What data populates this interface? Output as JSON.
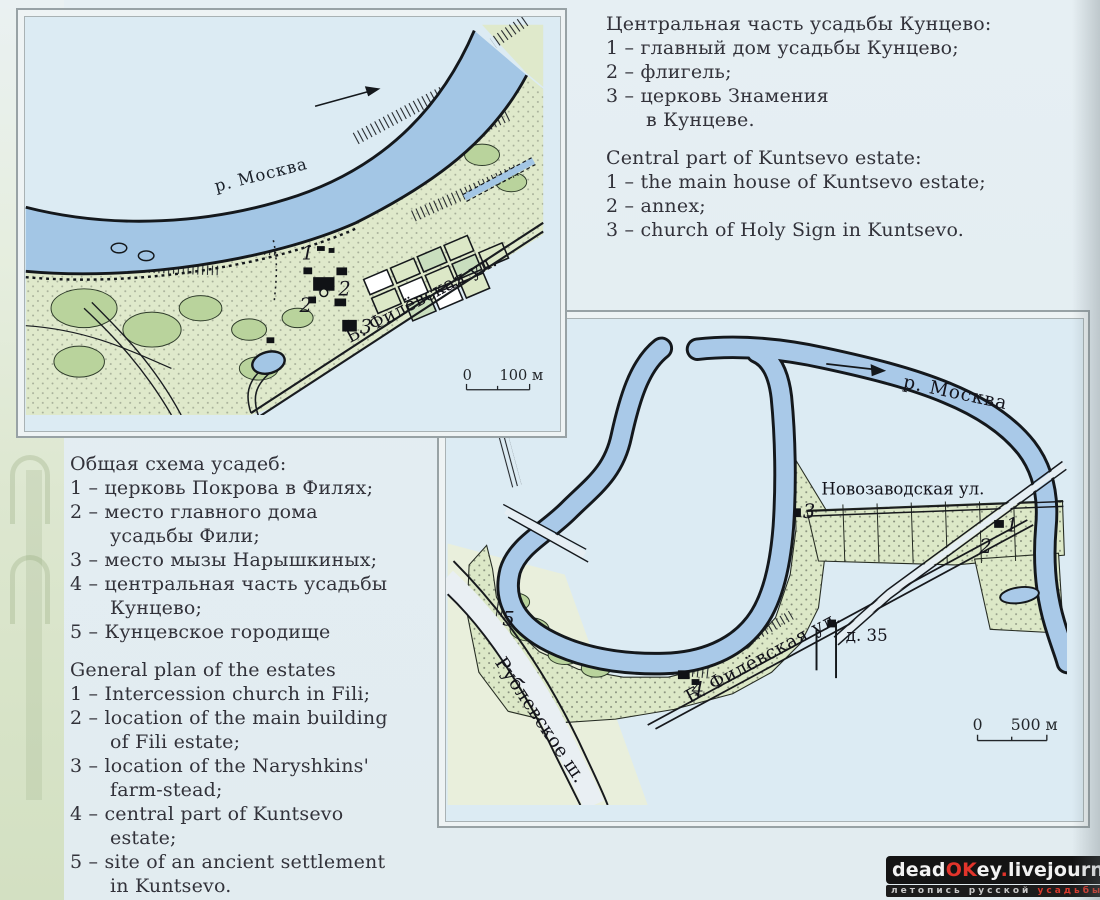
{
  "palette": {
    "paper": "#dcebf3",
    "river": "#a9c9e8",
    "land": "#dde8c9",
    "tree": "#b9d39c",
    "frame": "#98a2a5",
    "ink": "#14181c",
    "watermark_red": "#c1272d"
  },
  "legends": {
    "kuntsevo_ru": [
      "Центральная часть усадьбы Кунцево:",
      "1 – главный дом усадьбы Кунцево;",
      "2 – флигель;",
      "3 – церковь Знамения",
      "в Кунцеве."
    ],
    "kuntsevo_en": [
      "Central part of Kuntsevo estate:",
      "1 – the main house of Kuntsevo estate;",
      "2 – annex;",
      "3 – church of Holy Sign in Kuntsevo."
    ],
    "general_ru": [
      "Общая схема усадеб:",
      "1 – церковь Покрова в Филях;",
      "2 – место главного дома",
      "усадьбы Фили;",
      "3 – место мызы Нарышкиных;",
      "4 – центральная часть усадьбы",
      "Кунцево;",
      "5 – Кунцевское городище"
    ],
    "general_en": [
      "General plan of the estates",
      "1 – Intercession church in Fili;",
      "2 – location of the main building",
      "of Fili estate;",
      "3 – location of the Naryshkins'",
      "farm-stead;",
      "4 – central part of Kuntsevo",
      "estate;",
      "5 – site of an ancient settlement",
      "in Kuntsevo."
    ]
  },
  "map1": {
    "river_label": "р. Москва",
    "street_label": "Б. Филёвская ул.",
    "marker_1": "1",
    "marker_2a": "2",
    "marker_2b": "2",
    "marker_3": "3",
    "scale_zero": "0",
    "scale_label": "100 м"
  },
  "map2": {
    "river_label": "р. Москва",
    "street_novozavodskaya": "Новозаводская ул.",
    "street_filevskaya": "Б. Филёвская ул.",
    "road_rublevskoe": "Рублевское ш.",
    "building_label": "д. 35",
    "marker_1": "1",
    "marker_2": "2",
    "marker_3": "3",
    "marker_4": "4",
    "marker_5": "5",
    "scale_zero": "0",
    "scale_label": "500 м"
  },
  "watermark": {
    "p1": "dead",
    "p2": "OK",
    "p3": "ey",
    "p4": ".",
    "p5": "livejournal",
    "p6": ".com",
    "sub1": "летопись русской ",
    "sub2": "усадьбы"
  }
}
